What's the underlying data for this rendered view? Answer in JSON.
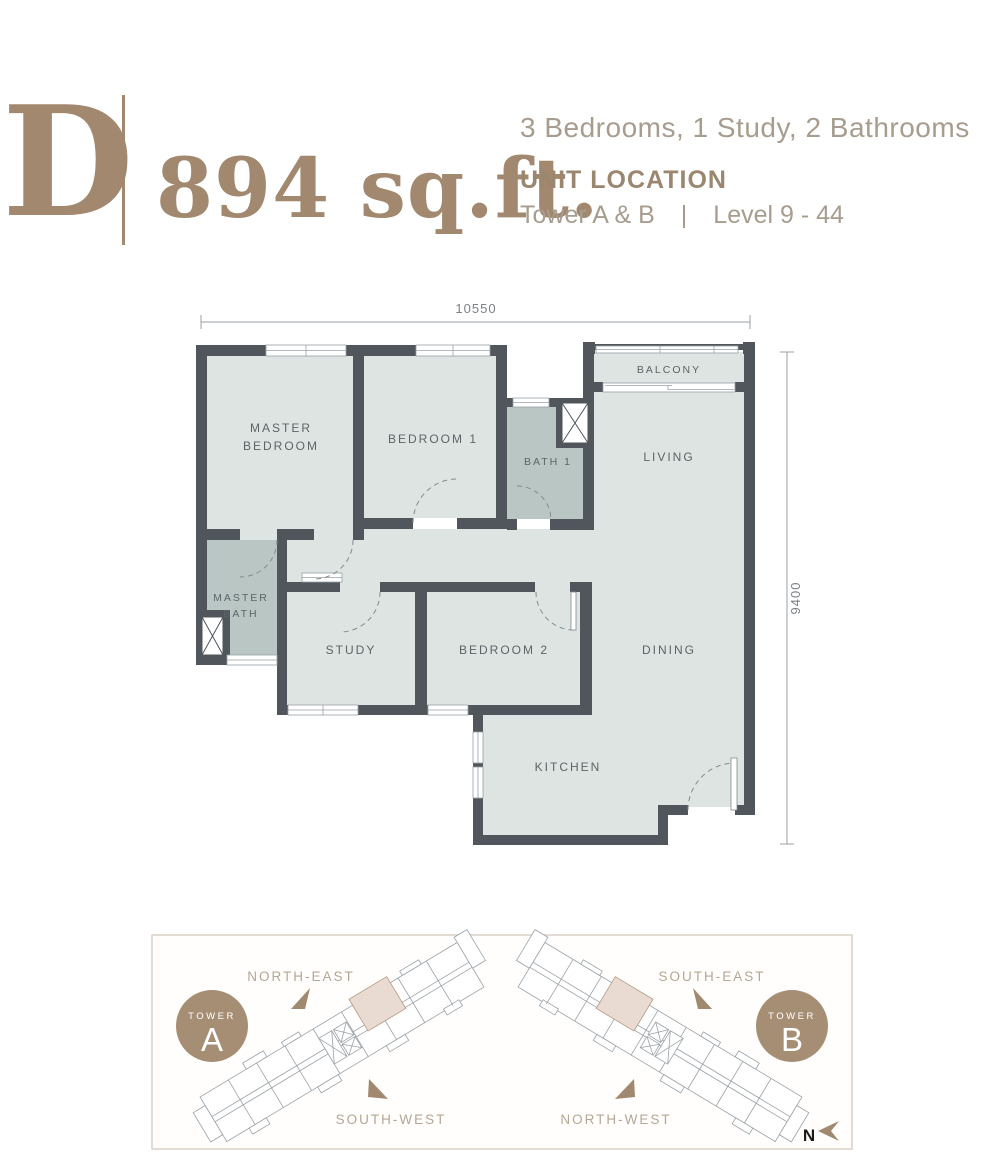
{
  "header": {
    "unit_letter": "D",
    "unit_area": "894 sq.ft.",
    "unit_summary": "3 Bedrooms, 1 Study, 2 Bathrooms",
    "unit_location_title": "UNIT LOCATION",
    "unit_location_towers": "Tower A & B",
    "unit_location_divider": "|",
    "unit_location_levels": "Level 9 - 44"
  },
  "floor_plan": {
    "dimension_top": "10550",
    "dimension_right": "9400",
    "rooms": {
      "master_bedroom_line1": "MASTER",
      "master_bedroom_line2": "BEDROOM",
      "bedroom1": "BEDROOM 1",
      "bath1": "BATH 1",
      "living": "LIVING",
      "balcony": "BALCONY",
      "master_bath_line1": "MASTER",
      "master_bath_line2": "BATH",
      "study": "STUDY",
      "bedroom2": "BEDROOM 2",
      "dining": "DINING",
      "kitchen": "KITCHEN"
    }
  },
  "location_map": {
    "tower_a": {
      "badge_label": "TOWER",
      "badge_letter": "A",
      "direction_top": "NORTH-EAST",
      "direction_bottom": "SOUTH-WEST"
    },
    "tower_b": {
      "badge_label": "TOWER",
      "badge_letter": "B",
      "direction_top": "SOUTH-EAST",
      "direction_bottom": "NORTH-WEST"
    },
    "compass_label": "N"
  },
  "colors": {
    "accent_tan": "#a1886e",
    "wall": "#50565c",
    "room_fill": "#dde4e2",
    "bath_fill": "#b9c6c3",
    "highlight_unit": "#e9dbd2"
  }
}
